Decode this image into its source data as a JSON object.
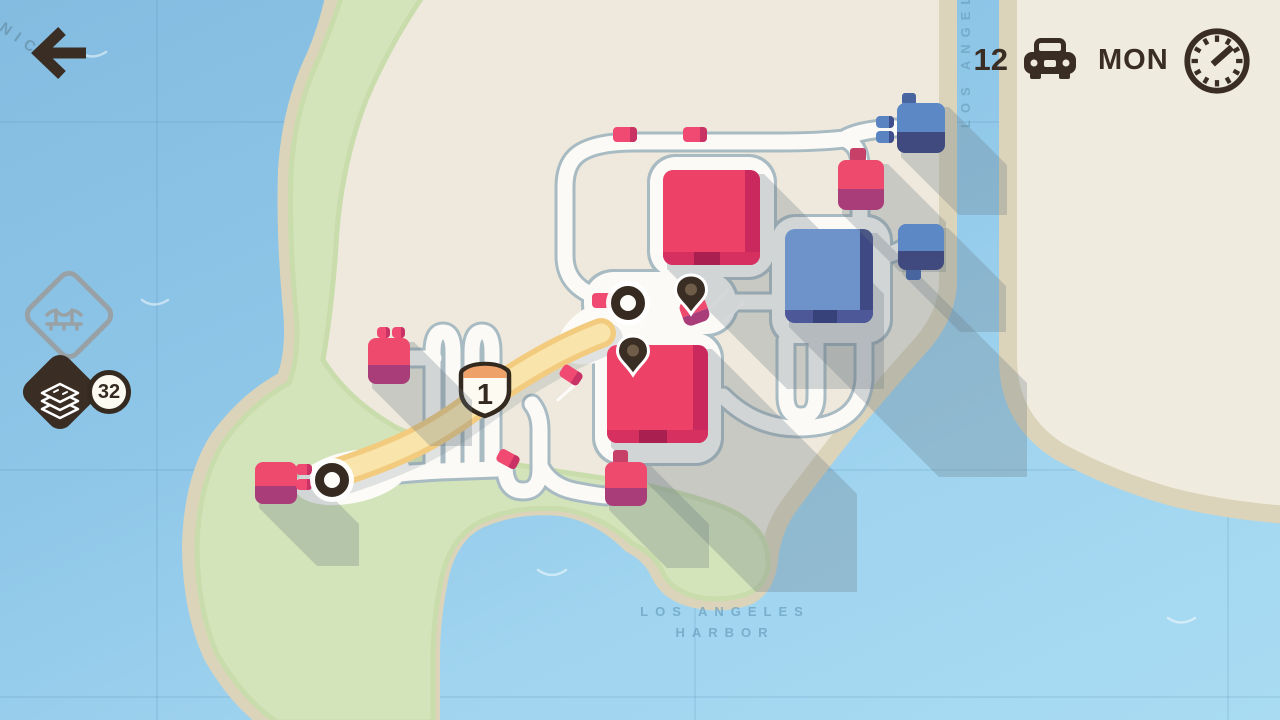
{
  "hud": {
    "back_icon": "back-arrow-icon",
    "vehicle_count": "12",
    "vehicle_icon": "car-icon",
    "day": "MON",
    "clock_icon": "clock-icon"
  },
  "resources": {
    "bridge_icon": "bridge-upgrade-icon",
    "road_tiles_icon": "road-tiles-icon",
    "road_tiles_count": "32"
  },
  "labels": {
    "bay": "SANTA MONICA",
    "river": "LOS ANGELES",
    "harbor_line1": "LOS ANGELES",
    "harbor_line2": "HARBOR"
  },
  "motorway": {
    "shield_number": "1"
  },
  "colors": {
    "hud_brown": "#3a2d23",
    "icon_gray": "#98a1a6",
    "water": "#8ec6e8",
    "land": "#eee9dc",
    "land_right": "#f0ebdf",
    "coast": "#dbd4ba",
    "park": "#d3e4ba",
    "road_outline": "#a8bac2",
    "road_fill": "#fbfaf6",
    "motorway_outer": "#f2cb7e",
    "motorway_inner": "#f9e5ab",
    "shadow": "rgba(103,119,128,0.28)",
    "red_body": "#ee4168",
    "red_fold": "#c9295c",
    "red_lip": "#d63061",
    "red_notch": "#a91f50",
    "blue_body": "#6d93ca",
    "blue_fold": "#3f4a85",
    "blue_lip": "#4d5898",
    "blue_notch": "#38427a",
    "red_house_top": "#ee4a6e",
    "red_house_bottom": "#a93d7a",
    "red_chimney": "#c74068",
    "blue_house_top": "#5c88c5",
    "blue_house_bottom": "#404a7e",
    "blue_chimney": "#49659f",
    "red_car": "#f04a72",
    "red_car_dark": "#c93264",
    "blue_car": "#5a83c2",
    "blue_car_dark": "#3f4f8d",
    "pin": "#3a2d23",
    "pin_dot": "#6f5c49",
    "node_ring": "#372b21"
  },
  "scene": {
    "big_buildings": [
      {
        "name": "big-building-red-1",
        "color": "red",
        "body": [
          663,
          170,
          97,
          95
        ],
        "shadow": 120
      },
      {
        "name": "big-building-red-2",
        "color": "red",
        "body": [
          607,
          345,
          101,
          98
        ],
        "shadow": 145
      },
      {
        "name": "big-building-blue-1",
        "color": "blue",
        "body": [
          785,
          229,
          88,
          94
        ],
        "shadow": 150
      }
    ],
    "houses": [
      {
        "name": "house-red-southwest",
        "color": "red",
        "rect": [
          255,
          462,
          42,
          42
        ],
        "chimney": null,
        "angle": 0,
        "shadow": 58
      },
      {
        "name": "house-red-west",
        "color": "red",
        "rect": [
          368,
          338,
          42,
          46
        ],
        "chimney": null,
        "angle": 0,
        "shadow": 58
      },
      {
        "name": "house-red-northeast",
        "color": "red",
        "rect": [
          838,
          160,
          46,
          50
        ],
        "chimney": [
          850,
          148,
          16,
          14
        ],
        "angle": 0,
        "shadow": 58
      },
      {
        "name": "house-red-south",
        "color": "red",
        "rect": [
          605,
          462,
          42,
          44
        ],
        "chimney": [
          613,
          450,
          15,
          14
        ],
        "angle": 0,
        "shadow": 58
      },
      {
        "name": "house-blue-north",
        "color": "blue",
        "rect": [
          897,
          103,
          48,
          50
        ],
        "chimney": [
          902,
          93,
          14,
          12
        ],
        "angle": 0,
        "shadow": 58
      },
      {
        "name": "house-blue-east",
        "color": "blue",
        "rect": [
          898,
          224,
          46,
          46
        ],
        "chimney": [
          906,
          268,
          15,
          12
        ],
        "angle": 0,
        "shadow": 58
      },
      {
        "name": "house-red-pinned",
        "color": "red",
        "rect": [
          681,
          298,
          27,
          26
        ],
        "chimney": null,
        "angle": -20,
        "shadow": 0
      }
    ],
    "cars": [
      {
        "x": 613,
        "y": 127,
        "w": 24,
        "h": 15,
        "angle": 0,
        "color": "red"
      },
      {
        "x": 683,
        "y": 127,
        "w": 24,
        "h": 15,
        "angle": 0,
        "color": "red"
      },
      {
        "x": 592,
        "y": 293,
        "w": 24,
        "h": 15,
        "angle": 0,
        "color": "red"
      },
      {
        "x": 560,
        "y": 368,
        "w": 22,
        "h": 14,
        "angle": 33,
        "color": "red"
      },
      {
        "x": 497,
        "y": 452,
        "w": 22,
        "h": 14,
        "angle": 28,
        "color": "red"
      },
      {
        "x": 296,
        "y": 464,
        "w": 16,
        "h": 11,
        "angle": 0,
        "color": "red"
      },
      {
        "x": 296,
        "y": 479,
        "w": 16,
        "h": 11,
        "angle": 0,
        "color": "red"
      },
      {
        "x": 377,
        "y": 327,
        "w": 13,
        "h": 11,
        "angle": 0,
        "color": "red"
      },
      {
        "x": 392,
        "y": 327,
        "w": 13,
        "h": 11,
        "angle": 0,
        "color": "red"
      },
      {
        "x": 876,
        "y": 116,
        "w": 18,
        "h": 12,
        "angle": 0,
        "color": "blue"
      },
      {
        "x": 876,
        "y": 131,
        "w": 18,
        "h": 12,
        "angle": 0,
        "color": "blue"
      }
    ],
    "pins": [
      {
        "x": 691,
        "y": 316
      },
      {
        "x": 633,
        "y": 377
      }
    ],
    "nodes": [
      {
        "x": 332,
        "y": 480
      },
      {
        "x": 628,
        "y": 303
      }
    ]
  }
}
